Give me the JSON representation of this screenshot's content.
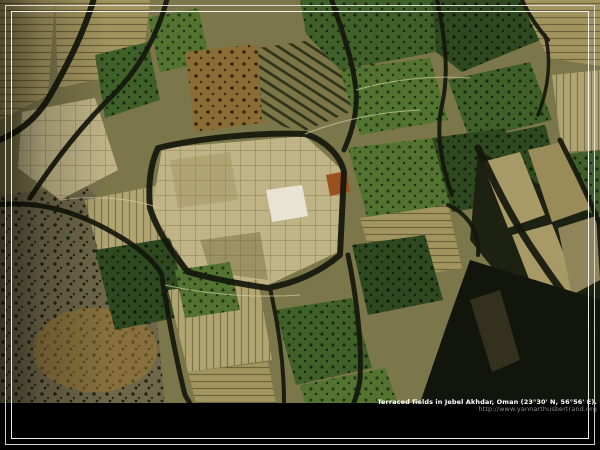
{
  "caption": {
    "title": "Terraced fields in Jebel Akhdar, Oman (23°30' N, 56°56' E).",
    "url": "http://www.yannarthusbertrand.org"
  },
  "photo": {
    "description": "Aerial photograph of terraced agricultural fields: green crop plots, tan and beige fallow terraces and bare earth separated by dark winding ravines and stone walls, rocky scrub slope at lower left, deep shadow at lower right"
  },
  "colors": {
    "background": "#000000",
    "frame_outer": "#e1e1e1",
    "frame_inner": "#f8f8f8",
    "caption_text": "#ffffff",
    "url_text": "#8b8b8b",
    "field_green_bright": "#527430",
    "field_green_mid": "#40602a",
    "field_green_dark": "#2e481f",
    "field_tan": "#a2945f",
    "field_beige": "#c0b487",
    "earth_brown": "#8a6d35",
    "ochre": "#a07a30",
    "white_plot": "#e8e4d4",
    "rust_plot": "#99511f",
    "ravine": "#14170c"
  }
}
